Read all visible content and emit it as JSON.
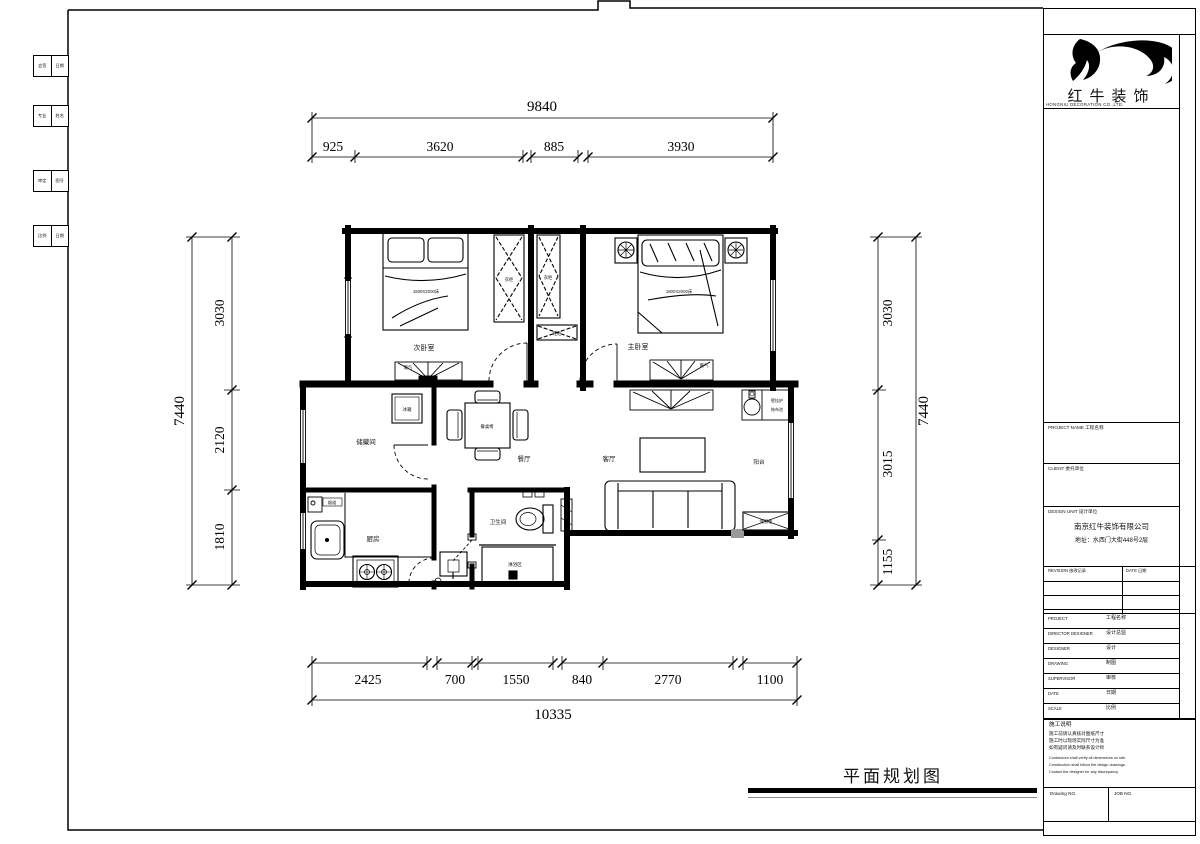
{
  "sheet": {
    "drawing_title": "平面规划图",
    "company_logo": "红牛装饰",
    "logo_sub": "HONGNIU DECORATION CO.,LTD."
  },
  "signoff": {
    "b1l": "会签",
    "b1r": "日期",
    "b2l": "专业",
    "b2r": "姓名",
    "b3l": "审定",
    "b3r": "图号",
    "b4l": "比例",
    "b4r": "日期"
  },
  "dims": {
    "top_total": "9840",
    "top1": "925",
    "top2": "3620",
    "top3": "885",
    "top4": "3930",
    "left_total": "7440",
    "left1": "3030",
    "left2": "2120",
    "left3": "1810",
    "right_total": "7440",
    "right1": "3030",
    "right2": "3015",
    "right3": "1155",
    "bot1": "2425",
    "bot2": "700",
    "bot3": "1550",
    "bot4": "840",
    "bot5": "2770",
    "bot6": "1100",
    "bot_total": "10335"
  },
  "rooms": {
    "bedroom2": "次卧室",
    "master": "主卧室",
    "storage": "储藏间",
    "kitchen": "厨房",
    "bath": "卫生间",
    "shower": "淋浴区",
    "dining": "餐厅",
    "living": "客厅",
    "balcony": "阳台"
  },
  "labels": {
    "bed2_size": "1500X2000床",
    "master_bed_size": "1800X2000床",
    "wardrobe": "衣柜",
    "shoe_cabinet": "鞋柜",
    "radiator": "暖气",
    "fridge": "冰箱",
    "flue": "烟道",
    "dining_set": "餐桌椅",
    "boiler": "壁挂炉",
    "mop_sink": "拖布池",
    "storage_cabinet": "储物柜"
  },
  "title_block": {
    "sec_project": "PROJECT NAME 工程名称",
    "sec_client": "CLIENT 委托单位",
    "sec_design": "DESIGN UNIT 设计单位",
    "company_name": "南京红牛装饰有限公司",
    "company_address": "地址：水西门大街448号2层",
    "rev_no": "REVISION 修改记录",
    "rev_date": "DATE 日期",
    "rows": [
      {
        "en": "PROJECT",
        "cn": "工程名称"
      },
      {
        "en": "DIRECTOR DESIGNER",
        "cn": "设计总监"
      },
      {
        "en": "DESIGNER",
        "cn": "设计"
      },
      {
        "en": "DRAWING",
        "cn": "制图"
      },
      {
        "en": "SUPERVISOR",
        "cn": "审核"
      },
      {
        "en": "DATE",
        "cn": "日期"
      },
      {
        "en": "SCALE",
        "cn": "比例"
      }
    ],
    "notes_title": "施工说明",
    "notes_cn": [
      "施工前请认真核对图纸尺寸",
      "施工时以现场实际尺寸为准",
      "如有疑问请及时联系设计师"
    ],
    "notes_en": [
      "Contractors shall verify all dimensions on site.",
      "Construction shall follow the design drawings.",
      "Contact the designer for any discrepancy."
    ],
    "drawing_no_label": "Drawing NO.",
    "job_no_label": "JOB NO."
  }
}
